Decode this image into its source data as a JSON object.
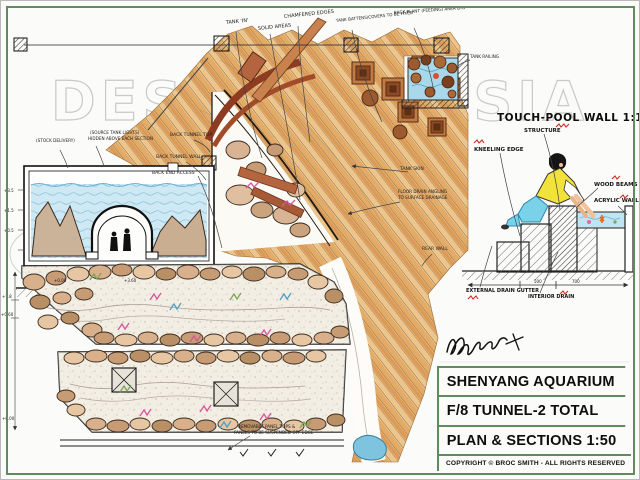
{
  "page": {
    "watermark": "DESIGNED ASIA",
    "accent_green": "#5e8c60",
    "annotation_red": "#cf2b24"
  },
  "title_block": {
    "line1": "SHENYANG AQUARIUM",
    "line2": "F/8 TUNNEL-2 TOTAL",
    "line3": "PLAN & SECTIONS 1:50",
    "copyright": "COPYRIGHT © BROC SMITH - ALL RIGHTS RESERVED"
  },
  "signature": "Broc Smith",
  "touch_pool": {
    "title": "TOUCH-POOL WALL 1:10",
    "labels": {
      "structure": "STRUCTURE",
      "kneeling_edge": "KNEELING EDGE",
      "wood_beams": "WOOD BEAMS",
      "acrylic_wall": "ACRYLIC WALL",
      "external_drain": "EXTERNAL DRAIN GUTTER",
      "interior_drain": "INTERIOR DRAIN"
    },
    "dims": {
      "d1": "500",
      "d2": "700"
    }
  },
  "plan": {
    "labels": {
      "tank_in": "TANK 'IN'",
      "solid_areas": "SOLID AREAS",
      "chamfered_edges": "CHAMFERED EDGES",
      "tank_battens": "TANK BATTENS/COVERS TO BE FIXED",
      "back_plant": "BACK PLANT (FEEDING) AREA BYD",
      "tank_railing": "TANK RAILING",
      "stock_delivery": "(STOCK DELIVERY)",
      "tank_lights_1": "(SOURCE TANK LIGHTS)",
      "tank_lights_2": "HIDDEN ABOVE EACH SECTION",
      "back_tunnel_top": "BACK TUNNEL TOP",
      "back_tunnel_wall": "BACK TUNNEL WALL",
      "back_end_access": "BACK END ACCESS",
      "tank_skin": "TANK SKIN",
      "floor_drain_1": "FLOOR DRAIN ANGLING",
      "floor_drain_2": "TO SURFACE DRAINAGE",
      "rear_wall": "REAR WALL",
      "removable_1": "REMOVABLE PANEL TOPS &",
      "removable_2": "PANELS TO BE SUSPENDED OFF EDGE"
    },
    "dims": {
      "e1": "+3.5",
      "e2": "+1.5",
      "e3": "+0.5",
      "e4": "+0.00",
      "e5": "+3.60",
      "p1": "+1.8",
      "p2": "+0.60",
      "p3": "+0.00"
    }
  }
}
